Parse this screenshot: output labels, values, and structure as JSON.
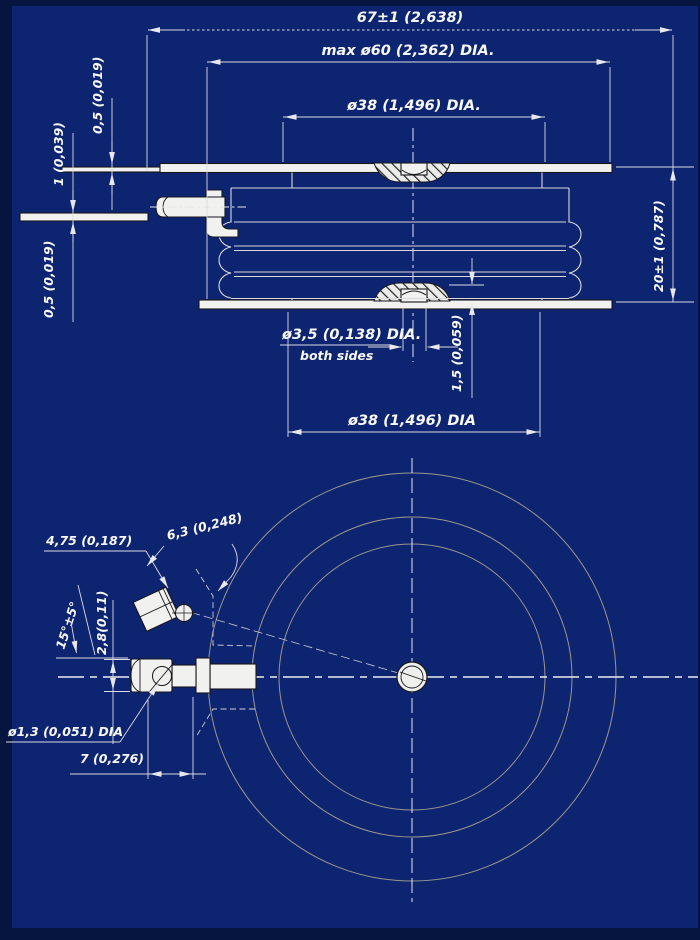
{
  "colors": {
    "frame": "#061540",
    "drawing_field": "#0d2470",
    "dimension_line": "#dcdce2",
    "centerline": "#e6e6ea",
    "object_outline": "#17171c",
    "object_fill": "#f1f1ef",
    "ceramic_line": "#d9d9de",
    "plan_circle_line": "#9b968c",
    "text": "#f8f8f8"
  },
  "side_view": {
    "labels": {
      "overall_width": "67±1 (2,638)",
      "max_diameter": "max ø60 (2,362) DIA.",
      "upper_pole_diameter": "ø38 (1,496) DIA.",
      "upper_sheet_thickness": "0,5 (0,019)",
      "lead_strip_thickness": "1 (0,039)",
      "lower_sheet_thickness": "0,5 (0,019)",
      "body_height": "20±1 (0,787)",
      "center_recess_diameter": "ø3,5 (0,138) DIA.",
      "center_recess_note": "both sides",
      "recess_depth": "1,5 (0,059)",
      "lower_pole_diameter": "ø38 (1,496) DIA"
    }
  },
  "plan_view": {
    "labels": {
      "gate_pad_width": "6,3 (0,248)",
      "gate_pad_length": "4,75 (0,187)",
      "gate_angle": "15°±5°",
      "lug_width": "2,8(0,11)",
      "lead_hole_diameter": "ø1,3 (0,051) DIA",
      "hole_to_edge": "7 (0,276)"
    }
  }
}
